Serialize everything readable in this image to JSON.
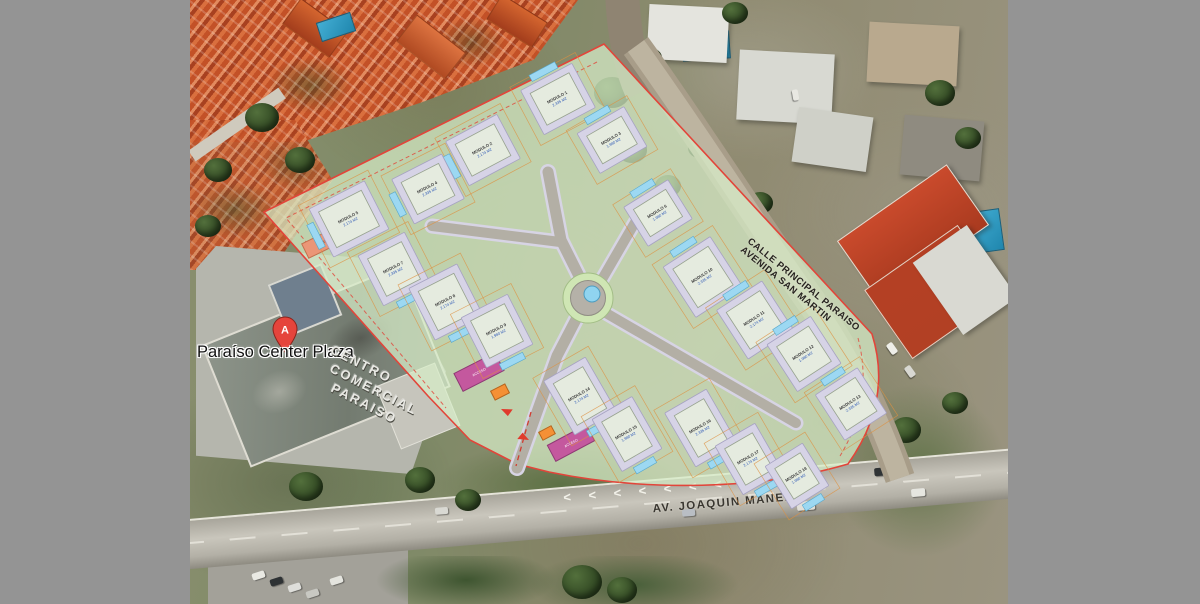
{
  "colors": {
    "gray_margin": "#949494",
    "plan_fill": "#d7edc8",
    "plan_border": "#e2453a",
    "road_fill": "#b3afa5",
    "road_edge": "#d7d4e4",
    "building_outer": "#d6d3e6",
    "building_inner": "#e5ebdf",
    "pool": "#9cd8f2",
    "lot_line": "#dd9040",
    "salmon": "#eb9677",
    "magenta": "#c4589e",
    "orange_gate": "#f59035",
    "roundabout_green": "#cfe6b4",
    "roundabout_gray": "#b5b1a8",
    "fountain": "#90d4f0"
  },
  "labels": {
    "pin_title": "Paraíso Center Plaza",
    "pin_letter": "A",
    "roof_line1": "CENTRO",
    "roof_line2": "COMERCIAL",
    "roof_line3": "PARAISO",
    "avenue": "AV. JOAQUIN MANEIRO",
    "street_line1": "CALLE PRINCIPAL PARAISO",
    "street_line2": "AVENIDA SAN MARTIN",
    "chevrons": "< < < < < < < <"
  },
  "plan": {
    "buildings": [
      {
        "n": 1,
        "x": 558,
        "y": 99,
        "w": 58,
        "h": 50,
        "rot": -28,
        "pool": "top",
        "l1": "MODULO 1",
        "l2": "2.335 M2"
      },
      {
        "n": 2,
        "x": 483,
        "y": 150,
        "w": 58,
        "h": 50,
        "rot": -28,
        "pool": "left",
        "l1": "MODULO 2",
        "l2": "2.174 M2"
      },
      {
        "n": 3,
        "x": 612,
        "y": 140,
        "w": 54,
        "h": 46,
        "rot": -30,
        "pool": "top",
        "l1": "MODULO 3",
        "l2": "1.980 M2"
      },
      {
        "n": 4,
        "x": 428,
        "y": 189,
        "w": 56,
        "h": 50,
        "rot": -27,
        "pool": "left",
        "l1": "MODULO 4",
        "l2": "2.335 M2"
      },
      {
        "n": 5,
        "x": 349,
        "y": 219,
        "w": 62,
        "h": 54,
        "rot": -27,
        "pool": "left",
        "l1": "MODULO 5",
        "l2": "2.174 M2"
      },
      {
        "n": 6,
        "x": 658,
        "y": 213,
        "w": 52,
        "h": 46,
        "rot": -32,
        "pool": "top",
        "l1": "MODULO 6",
        "l2": "1.980 M2"
      },
      {
        "n": 7,
        "x": 394,
        "y": 269,
        "w": 52,
        "h": 56,
        "rot": -27,
        "pool": "bottom",
        "l1": "MODULO 7",
        "l2": "2.335 M2"
      },
      {
        "n": 8,
        "x": 446,
        "y": 302,
        "w": 54,
        "h": 58,
        "rot": -27,
        "pool": "bottom",
        "l1": "MODULO 8",
        "l2": "2.174 M2"
      },
      {
        "n": 9,
        "x": 497,
        "y": 331,
        "w": 52,
        "h": 56,
        "rot": -27,
        "pool": "bottom",
        "l1": "MODULO 9",
        "l2": "1.980 M2"
      },
      {
        "n": 10,
        "x": 703,
        "y": 277,
        "w": 56,
        "h": 60,
        "rot": -33,
        "pool": "top",
        "l1": "MODULO 10",
        "l2": "2.335 M2"
      },
      {
        "n": 11,
        "x": 755,
        "y": 320,
        "w": 54,
        "h": 58,
        "rot": -33,
        "pool": "top",
        "l1": "MODULO 11",
        "l2": "2.174 M2"
      },
      {
        "n": 12,
        "x": 804,
        "y": 354,
        "w": 52,
        "h": 56,
        "rot": -33,
        "pool": "top",
        "l1": "MODULO 12",
        "l2": "1.980 M2"
      },
      {
        "n": 13,
        "x": 851,
        "y": 404,
        "w": 50,
        "h": 54,
        "rot": -33,
        "pool": "top",
        "l1": "MODULO 13",
        "l2": "2.335 M2"
      },
      {
        "n": 14,
        "x": 580,
        "y": 396,
        "w": 48,
        "h": 62,
        "rot": -30,
        "pool": "bottom",
        "l1": "MODULO 14",
        "l2": "2.174 M2"
      },
      {
        "n": 15,
        "x": 627,
        "y": 434,
        "w": 46,
        "h": 60,
        "rot": -30,
        "pool": "bottom",
        "l1": "MODULO 15",
        "l2": "1.980 M2"
      },
      {
        "n": 16,
        "x": 701,
        "y": 428,
        "w": 48,
        "h": 62,
        "rot": -30,
        "pool": "bottom",
        "l1": "MODULO 16",
        "l2": "2.335 M2"
      },
      {
        "n": 17,
        "x": 749,
        "y": 459,
        "w": 46,
        "h": 56,
        "rot": -30,
        "pool": "bottom",
        "l1": "MODULO 17",
        "l2": "2.174 M2"
      },
      {
        "n": 18,
        "x": 797,
        "y": 476,
        "w": 44,
        "h": 50,
        "rot": -32,
        "pool": "bottom",
        "l1": "MODULO 18",
        "l2": "1.980 M2"
      }
    ],
    "zones": [
      {
        "kind": "parking-strip",
        "x": 334,
        "y": 237,
        "rot": -26,
        "w": 64,
        "h": 16,
        "fill": "#eb9677",
        "stroke": "#c2714f",
        "label": "ESTACIONAMIENTO",
        "lcolor": "#6e3619"
      },
      {
        "kind": "gate",
        "x": 479,
        "y": 372,
        "rot": -27,
        "w": 46,
        "h": 20,
        "fill": "#c4589e",
        "stroke": "#8e3a74",
        "label": "ACCESO",
        "lcolor": "#ffffff"
      },
      {
        "kind": "gate",
        "x": 571,
        "y": 443,
        "rot": -28,
        "w": 44,
        "h": 18,
        "fill": "#c4589e",
        "stroke": "#8e3a74",
        "label": "ACCESO",
        "lcolor": "#ffffff"
      },
      {
        "kind": "guard-post",
        "x": 500,
        "y": 392,
        "rot": -27,
        "w": 16,
        "h": 10,
        "fill": "#f59035",
        "stroke": "#b5641d",
        "label": "",
        "lcolor": "#ffffff"
      },
      {
        "kind": "guard-post",
        "x": 547,
        "y": 433,
        "rot": -28,
        "w": 14,
        "h": 9,
        "fill": "#f59035",
        "stroke": "#b5641d",
        "label": "",
        "lcolor": "#ffffff"
      }
    ]
  }
}
